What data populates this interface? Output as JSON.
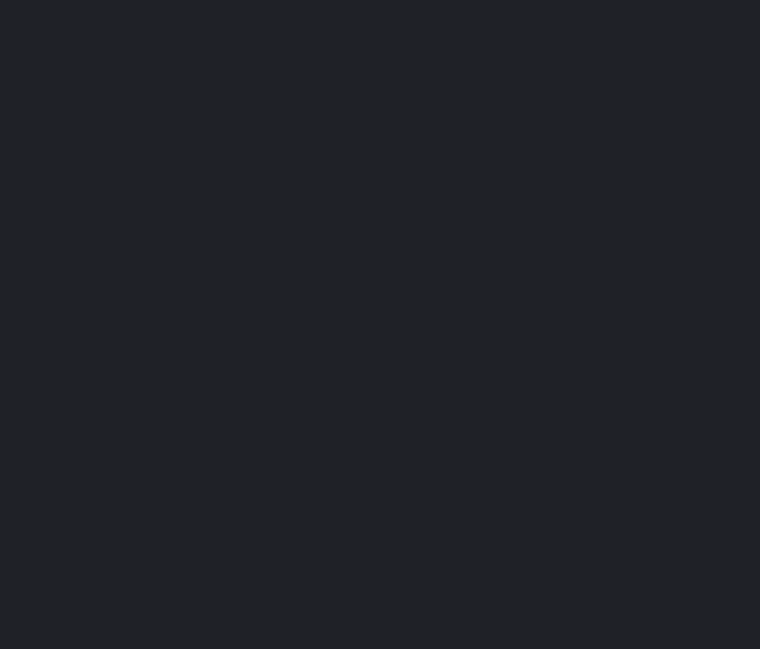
{
  "colors": {
    "background": "#1f2127"
  }
}
